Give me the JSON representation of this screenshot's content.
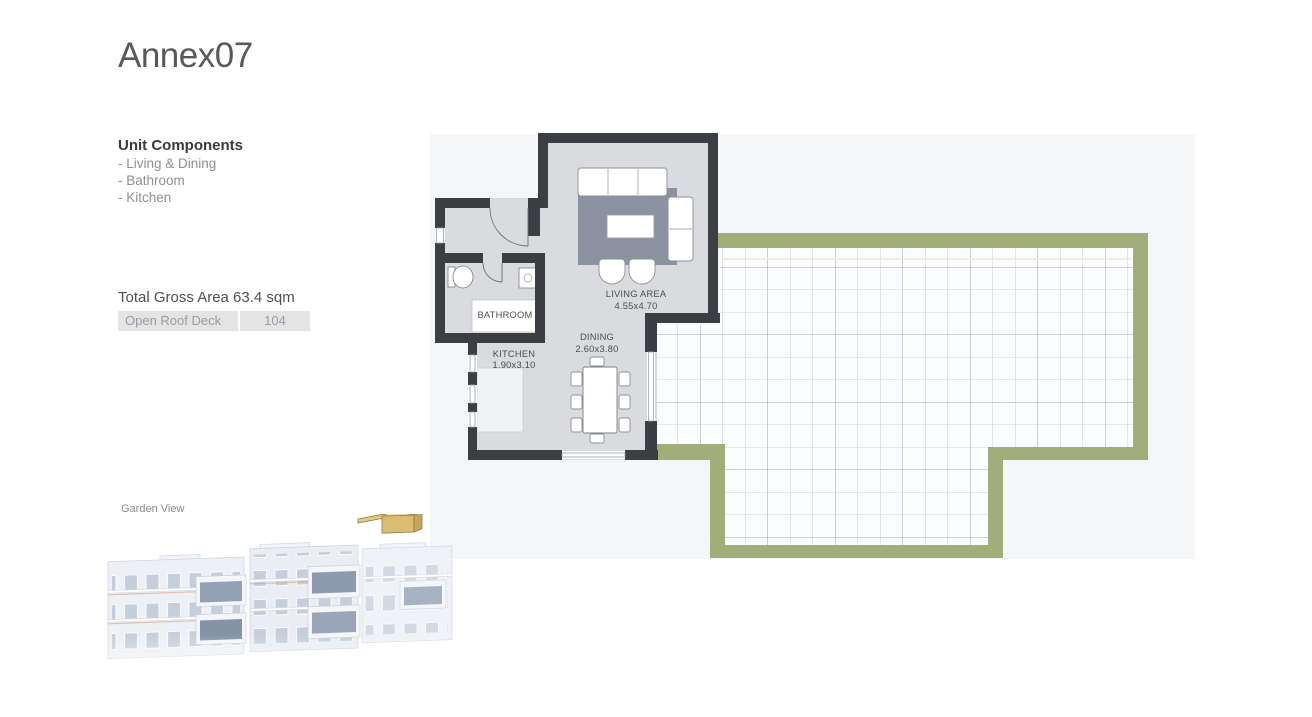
{
  "page": {
    "title": "Annex07"
  },
  "sidebar": {
    "unit_components": {
      "heading": "Unit Components",
      "items": [
        "- Living & Dining",
        "- Bathroom",
        "- Kitchen"
      ]
    },
    "total_gross_area": "Total Gross Area 63.4 sqm",
    "area_rows": [
      {
        "label": "Open Roof Deck",
        "value": "104"
      }
    ],
    "view_label": "Garden View"
  },
  "floor_plan": {
    "rooms": {
      "living": {
        "name": "LIVING AREA",
        "dims": "4.55x4.70"
      },
      "dining": {
        "name": "DINING",
        "dims": "2.60x3.80"
      },
      "kitchen": {
        "name": "KITCHEN",
        "dims": "1.90x3.10"
      },
      "bathroom": {
        "name": "BATHROOM"
      }
    },
    "outdoor": {
      "name": "Open Roof Deck"
    }
  },
  "colors": {
    "wall": "#3b3e42",
    "deck_wall_green": "#a2ae79",
    "unit_floor": "#d9dbde",
    "rug": "#8c92a1",
    "panel_bg": "#f5f6f7",
    "box_bg": "#e3e4e6",
    "highlight_unit": "#d9ba6c",
    "text_dark": "#3a3a3c",
    "text_muted": "#8f9092"
  }
}
